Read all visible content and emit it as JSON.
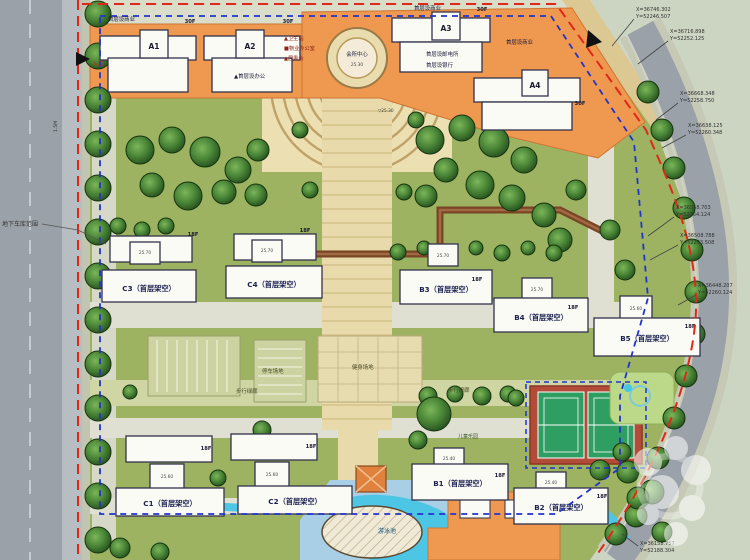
{
  "colors": {
    "boundary_red": "#e02818",
    "garage_blue": "#2233cc",
    "podium_orange": "#ef9850",
    "lawn_green": "#9db361",
    "water_cyan": "#4cc6e4",
    "tennis_red": "#b24c38",
    "tennis_green": "#2f9e62"
  },
  "entrance": {
    "label": "入口"
  },
  "garage": {
    "label": "地下车库范围"
  },
  "legend": {
    "line1": "▲卫生站",
    "line2": "■物业办公室",
    "line3": "▲居委会"
  },
  "clubhouse": {
    "name": "会所中心",
    "level": "25.30"
  },
  "notes": {
    "shops": "首层设商业",
    "post": "首层设邮电所",
    "bank": "首层设银行",
    "office": "▲首层设办公"
  },
  "site": {
    "corridor": "步行绿廊",
    "parking": "停车场地",
    "fitness": "健身场地",
    "children": "儿童乐园",
    "pool": "游泳池",
    "plaza_level": "▽25.30",
    "road_width": "1.5M"
  },
  "towers": [
    {
      "id": "A1",
      "floors": "30F"
    },
    {
      "id": "A2",
      "floors": "30F"
    },
    {
      "id": "A3",
      "floors": "30F"
    },
    {
      "id": "A4",
      "floors": "30F"
    }
  ],
  "slabs": [
    {
      "label": "C3（首层架空）",
      "floors": "18F",
      "level": "25.70"
    },
    {
      "label": "C4（首层架空）",
      "floors": "18F",
      "level": "25.70"
    },
    {
      "label": "B3（首层架空）",
      "floors": "18F",
      "level": "25.70"
    },
    {
      "label": "B4（首层架空）",
      "floors": "18F",
      "level": "25.70"
    },
    {
      "label": "B5（首层架空）",
      "floors": "18F",
      "level": "25.60"
    },
    {
      "label": "C1（首层架空）",
      "floors": "18F",
      "level": "25.60"
    },
    {
      "label": "C2（首层架空）",
      "floors": "18F",
      "level": "25.60"
    },
    {
      "label": "B1（首层架空）",
      "floors": "18F",
      "level": "25.40"
    },
    {
      "label": "B2（首层架空）",
      "floors": "18F",
      "level": "25.40"
    }
  ],
  "callouts": [
    {
      "x": "X=36746.302",
      "y": "Y=52246.507"
    },
    {
      "x": "X=36716.898",
      "y": "Y=52252.125"
    },
    {
      "x": "X=36668.348",
      "y": "Y=52258.750"
    },
    {
      "x": "X=36638.125",
      "y": "Y=52260.348"
    },
    {
      "x": "X=36558.703",
      "y": "Y=52264.124"
    },
    {
      "x": "X=36508.788",
      "y": "Y=52263.508"
    },
    {
      "x": "X=36448.207",
      "y": "Y=52260.124"
    },
    {
      "x": "X=36158.757",
      "y": "Y=52188.304"
    }
  ]
}
